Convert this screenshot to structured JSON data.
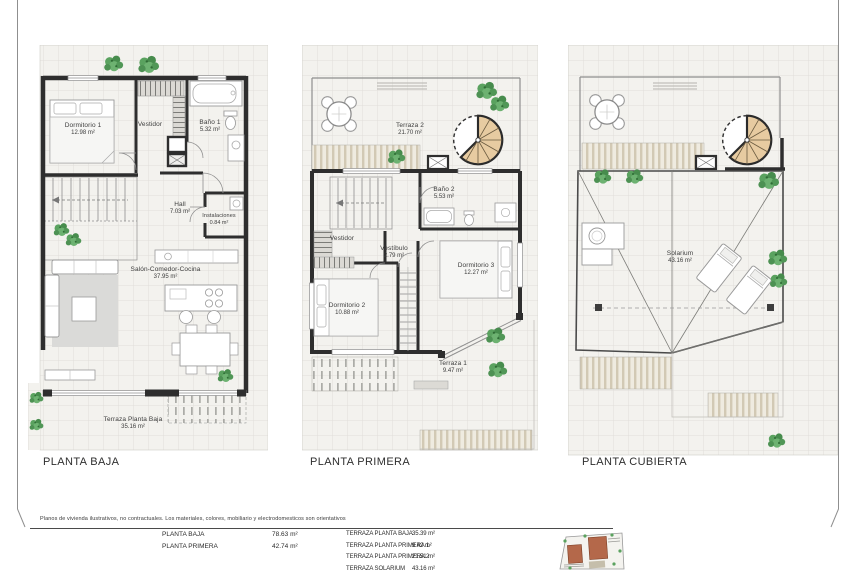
{
  "document": {
    "disclaimer": "Planos de vivienda ilustrativos, no contractuales. Los materiales, colores, mobiliario y electrodomesticos son orientativos"
  },
  "plans": [
    {
      "title": "PLANTA BAJA",
      "rooms": {
        "dormitorio1": {
          "name": "Dormitorio 1",
          "area": "12.98 m²"
        },
        "vestidor": {
          "name": "Vestidor",
          "area": ""
        },
        "bano1": {
          "name": "Baño 1",
          "area": "5.32 m²"
        },
        "hall": {
          "name": "Hall",
          "area": "7.03 m²"
        },
        "instalaciones": {
          "name": "Instalaciones",
          "area": "0.84 m²"
        },
        "salon": {
          "name": "Salón-Comedor-Cocina",
          "area": "37.95 m²"
        },
        "terraza": {
          "name": "Terraza Planta Baja",
          "area": "35.16 m²"
        }
      }
    },
    {
      "title": "PLANTA PRIMERA",
      "rooms": {
        "terraza2": {
          "name": "Terraza 2",
          "area": "21.70 m²"
        },
        "bano2": {
          "name": "Baño 2",
          "area": "5.53 m²"
        },
        "vestidor": {
          "name": "Vestidor",
          "area": ""
        },
        "vestibulo": {
          "name": "Vestíbulo",
          "area": "2.79 m²"
        },
        "dormitorio2": {
          "name": "Dormitorio 2",
          "area": "10.88 m²"
        },
        "dormitorio3": {
          "name": "Dormitorio 3",
          "area": "12.27 m²"
        },
        "terraza1": {
          "name": "Terraza 1",
          "area": "9.47 m²"
        }
      }
    },
    {
      "title": "PLANTA CUBIERTA",
      "rooms": {
        "solarium": {
          "name": "Solarium",
          "area": "43.16 m²"
        }
      }
    }
  ],
  "summary": {
    "left": [
      {
        "label": "PLANTA BAJA",
        "value": "78.63 m²"
      },
      {
        "label": "PLANTA PRIMERA",
        "value": "42.74 m²"
      }
    ],
    "right": [
      {
        "label": "TERRAZA PLANTA BAJA",
        "value": "35.39 m²"
      },
      {
        "label": "TERRAZA PLANTA PRIMERA 1",
        "value": "9.42 m²"
      },
      {
        "label": "TERRAZA PLANTA PRIMERA 2",
        "value": "21.51 m²"
      },
      {
        "label": "TERRAZA SOLARIUM",
        "value": "43.16 m²"
      }
    ]
  },
  "colors": {
    "wall": "#2e2e2e",
    "stair_wood": "#e7cba1",
    "plant": "#55a05a",
    "tile_bg": "#f3f2ee",
    "tile_line": "#e0deda",
    "deck": "#d2c9b4"
  }
}
